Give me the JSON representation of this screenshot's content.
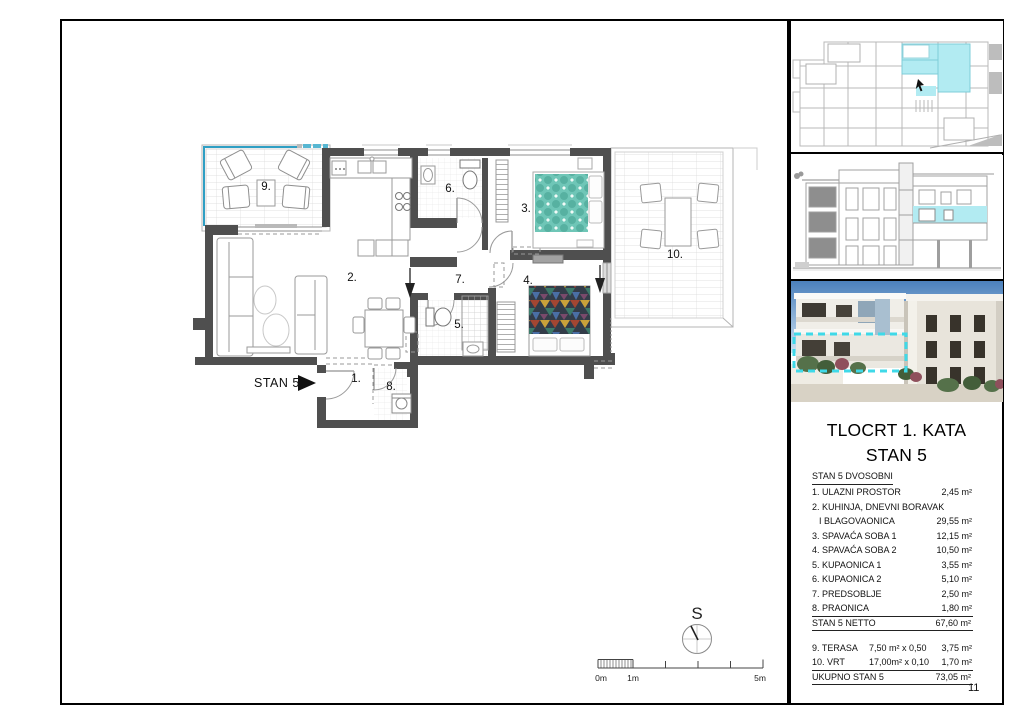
{
  "page": {
    "number": "11"
  },
  "plan": {
    "unit_label": "STAN 5",
    "compass_letter": "S",
    "room_labels": [
      {
        "text": "1.",
        "x": 356,
        "y": 382
      },
      {
        "text": "2.",
        "x": 352,
        "y": 281
      },
      {
        "text": "3.",
        "x": 526,
        "y": 212
      },
      {
        "text": "4.",
        "x": 528,
        "y": 284
      },
      {
        "text": "5.",
        "x": 459,
        "y": 328
      },
      {
        "text": "6.",
        "x": 450,
        "y": 192
      },
      {
        "text": "7.",
        "x": 460,
        "y": 283
      },
      {
        "text": "8.",
        "x": 391,
        "y": 390
      },
      {
        "text": "9.",
        "x": 266,
        "y": 190
      },
      {
        "text": "10.",
        "x": 675,
        "y": 258
      }
    ],
    "scale_labels": [
      {
        "text": "0m",
        "x": 601
      },
      {
        "text": "1m",
        "x": 633
      },
      {
        "text": "5m",
        "x": 760
      }
    ]
  },
  "panel": {
    "title_line1": "TLOCRT 1. KATA",
    "title_line2": "STAN 5",
    "legend": {
      "heading": "STAN 5  DVOSOBNI",
      "rows": [
        {
          "label": "1. ULAZNI PROSTOR",
          "calc": "",
          "value": "2,45 m²",
          "indent": false
        },
        {
          "label": "2. KUHINJA, DNEVNI BORAVAK",
          "calc": "",
          "value": "",
          "indent": false
        },
        {
          "label": "I BLAGOVAONICA",
          "calc": "",
          "value": "29,55 m²",
          "indent": true
        },
        {
          "label": "3. SPAVAĆA SOBA 1",
          "calc": "",
          "value": "12,15 m²",
          "indent": false
        },
        {
          "label": "4. SPAVAĆA SOBA 2",
          "calc": "",
          "value": "10,50 m²",
          "indent": false
        },
        {
          "label": "5. KUPAONICA 1",
          "calc": "",
          "value": "3,55 m²",
          "indent": false
        },
        {
          "label": "6. KUPAONICA 2",
          "calc": "",
          "value": "5,10 m²",
          "indent": false
        },
        {
          "label": "7. PREDSOBLJE",
          "calc": "",
          "value": "2,50 m²",
          "indent": false
        },
        {
          "label": "8. PRAONICA",
          "calc": "",
          "value": "1,80 m²",
          "indent": false
        }
      ],
      "subtotal": {
        "label": "STAN 5 NETTO",
        "value": "67,60 m²"
      },
      "outdoor_rows": [
        {
          "label": "9. TERASA",
          "calc": "7,50 m² x  0,50",
          "value": "3,75 m²"
        },
        {
          "label": "10. VRT",
          "calc": "17,00m² x 0,10",
          "value": "1,70 m²"
        }
      ],
      "total": {
        "label": "UKUPNO STAN 5",
        "value": "73,05 m²"
      }
    }
  },
  "colors": {
    "wall_gray": "#4f4f4f",
    "highlight_cyan": "#b2ebf2",
    "terrace_edge_blue": "#2f9fc4",
    "overlay_dashed_cyan": "#3fd9e8",
    "bed_teal": "#6fc6b7"
  }
}
